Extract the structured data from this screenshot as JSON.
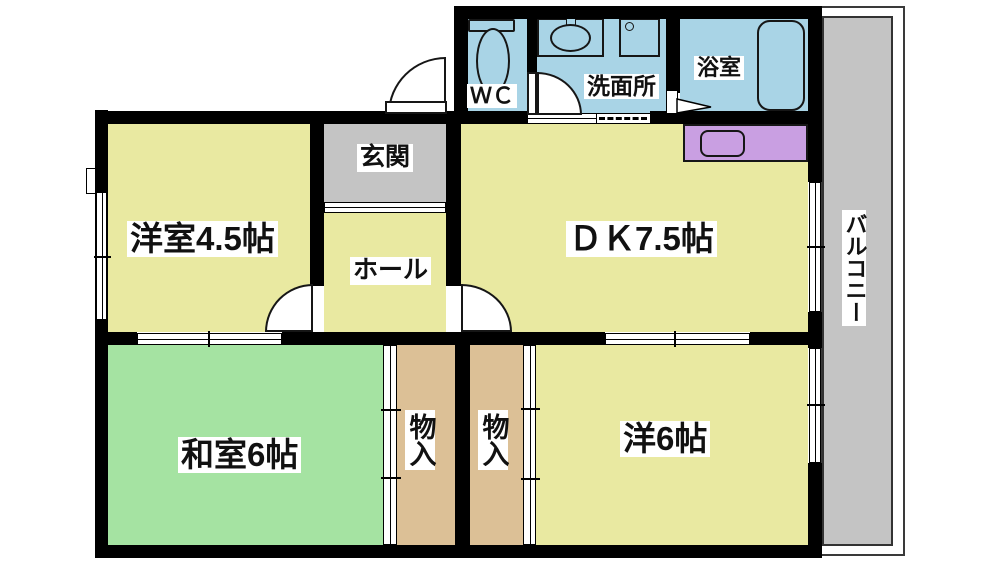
{
  "rooms": {
    "wc": {
      "label": "ＷＣ"
    },
    "washroom": {
      "label": "洗面所"
    },
    "bathroom": {
      "label": "浴室"
    },
    "entrance": {
      "label": "玄関"
    },
    "hall": {
      "label": "ホール"
    },
    "western_room_4_5": {
      "label": "洋室4.5帖"
    },
    "dining_kitchen": {
      "label": "ＤＫ7.5帖"
    },
    "japanese_room_6": {
      "label": "和室6帖"
    },
    "closet_left": {
      "label": "物入"
    },
    "closet_right": {
      "label": "物入"
    },
    "western_room_6": {
      "label": "洋6帖"
    },
    "balcony": {
      "label": "バルコニー"
    }
  },
  "colors": {
    "wet_area_blue": "#a9d4e6",
    "room_yellow": "#e9e9a1",
    "tatami_green": "#a5e3a2",
    "closet_tan": "#dcc096",
    "entrance_gray": "#c4c4c4",
    "balcony_gray": "#c4c4c4",
    "kitchen_counter_purple": "#c99fe2",
    "wall_black": "#000000"
  },
  "icons": {
    "toilet": "toilet-icon",
    "vanity_sink": "sink-icon",
    "washing_machine": "washing-machine-icon",
    "bathtub": "bathtub-icon",
    "kitchen_sink": "kitchen-sink-icon",
    "bathroom_door": "bathroom-door-icon"
  }
}
